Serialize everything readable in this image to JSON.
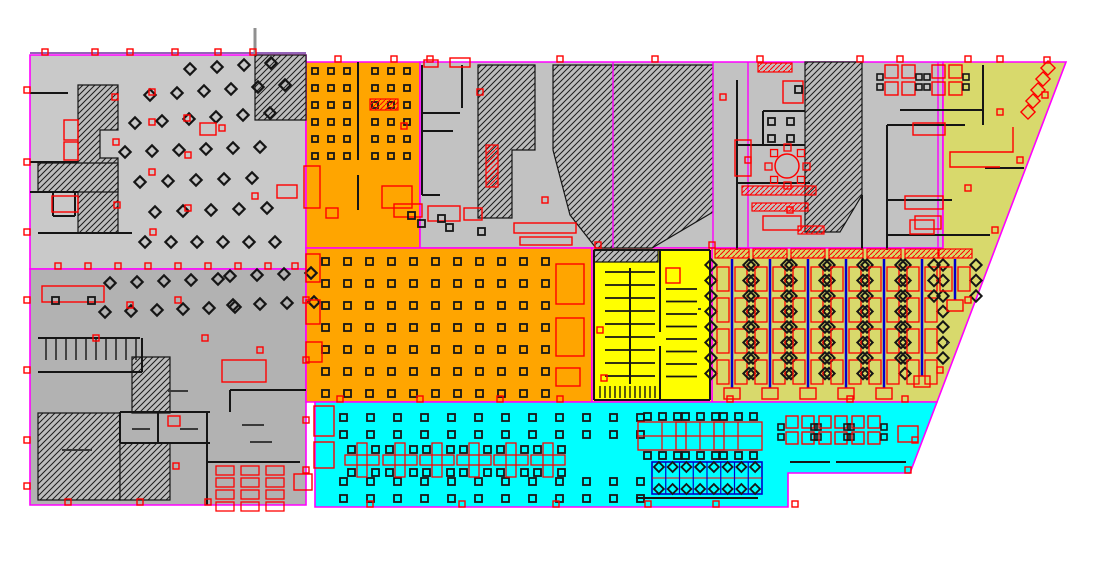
{
  "meta": {
    "width": 1111,
    "height": 562,
    "description": "CAD office floor plan with colored occupancy zones"
  },
  "colors": {
    "outline_magenta": "#FF00FF",
    "outline_violet": "#7030A0",
    "wall_black": "#151515",
    "furniture_red": "#FF0000",
    "accent_blue": "#0000CC",
    "zone_gray_light": "#C9C9C9",
    "zone_gray_mid": "#C2C2C2",
    "zone_gray_dark": "#B2B2B2",
    "zone_orange": "#FFA500",
    "zone_yellow": "#FFFF00",
    "zone_cyan": "#00FFFF",
    "zone_olive": "#D8D96C",
    "hatch_bg": "#BDBDBD",
    "pole_gray": "#909090",
    "chair_dark": "#161616",
    "label_gray": "#3a3a3a"
  },
  "zones": [
    {
      "name": "zone-left-upper-gray",
      "color": "zone_gray_light",
      "points": "30,55 306,55 306,269 30,269"
    },
    {
      "name": "zone-left-lower-gray",
      "color": "zone_gray_dark",
      "points": "30,269 306,269 306,505 30,505"
    },
    {
      "name": "zone-orange-upper",
      "color": "zone_orange",
      "points": "306,62 420,62 420,248 306,248"
    },
    {
      "name": "zone-center-gray-band",
      "color": "zone_gray_mid",
      "points": "420,62 943,62 943,248 420,248"
    },
    {
      "name": "zone-olive-right",
      "color": "zone_olive",
      "points": "943,62 1066,62 937,402 712,402 712,248 943,248"
    },
    {
      "name": "zone-orange-main",
      "color": "zone_orange",
      "points": "306,248 592,248 592,402 306,402"
    },
    {
      "name": "zone-yellow-core",
      "color": "zone_yellow",
      "points": "592,248 712,248 712,402 592,402"
    },
    {
      "name": "zone-cyan-open-office",
      "color": "zone_cyan",
      "points": "315,402 937,402 910,473 788,473 788,507 315,507"
    }
  ],
  "hatches": [
    {
      "name": "hatch-left-top-right",
      "points": "255,55 306,55 306,120 255,120"
    },
    {
      "name": "hatch-left-core",
      "points": "78,85 118,85 118,130 100,130 100,158 118,158 118,233 78,233"
    },
    {
      "name": "hatch-left-bar",
      "points": "38,163 118,163 118,192 38,192"
    },
    {
      "name": "hatch-lower-a",
      "points": "38,413 120,413 120,500 38,500"
    },
    {
      "name": "hatch-lower-b",
      "points": "120,443 170,443 170,500 120,500"
    },
    {
      "name": "hatch-lower-c",
      "points": "132,357 170,357 170,413 132,413"
    },
    {
      "name": "hatch-center-1",
      "points": "478,65 535,65 535,150 512,150 512,218 478,218"
    },
    {
      "name": "hatch-center-2",
      "points": "553,65 713,65 713,212 652,248 596,248 570,215 553,150"
    },
    {
      "name": "hatch-right-1",
      "points": "805,62 862,62 862,195 840,232 805,232"
    },
    {
      "name": "hatch-yellow-strip",
      "points": "594,250 658,250 658,262 594,262"
    }
  ],
  "magenta_lines": [
    [
      613,
      62,
      613,
      248
    ],
    [
      713,
      62,
      713,
      248
    ],
    [
      748,
      62,
      748,
      248
    ],
    [
      938,
      62,
      938,
      248
    ]
  ],
  "walls": [
    [
      30,
      93,
      68,
      93
    ],
    [
      30,
      162,
      78,
      162
    ],
    [
      30,
      192,
      78,
      192
    ],
    [
      53,
      192,
      53,
      216
    ],
    [
      75,
      192,
      75,
      216
    ],
    [
      53,
      216,
      75,
      216
    ],
    [
      38,
      233,
      132,
      233
    ],
    [
      38,
      338,
      140,
      338
    ],
    [
      38,
      372,
      142,
      372
    ],
    [
      142,
      338,
      142,
      372
    ],
    [
      120,
      412,
      210,
      412
    ],
    [
      120,
      443,
      210,
      443
    ],
    [
      120,
      412,
      120,
      443
    ],
    [
      158,
      412,
      158,
      443
    ],
    [
      207,
      412,
      207,
      443
    ],
    [
      207,
      443,
      207,
      505
    ],
    [
      207,
      462,
      300,
      462
    ],
    [
      230,
      390,
      306,
      390
    ],
    [
      230,
      390,
      230,
      412
    ],
    [
      422,
      65,
      422,
      195
    ],
    [
      422,
      113,
      460,
      113
    ],
    [
      422,
      131,
      453,
      131
    ],
    [
      462,
      65,
      462,
      108
    ],
    [
      422,
      195,
      440,
      195
    ],
    [
      737,
      80,
      737,
      250
    ],
    [
      737,
      145,
      805,
      145
    ],
    [
      763,
      111,
      805,
      111
    ],
    [
      763,
      111,
      763,
      145
    ],
    [
      737,
      183,
      810,
      183
    ],
    [
      862,
      195,
      862,
      250
    ],
    [
      887,
      125,
      887,
      250
    ],
    [
      887,
      125,
      965,
      125
    ],
    [
      983,
      65,
      983,
      125
    ],
    [
      900,
      110,
      983,
      110
    ],
    [
      985,
      168,
      1024,
      168
    ],
    [
      887,
      200,
      952,
      200
    ],
    [
      887,
      235,
      990,
      235
    ],
    [
      594,
      250,
      710,
      250
    ],
    [
      594,
      400,
      710,
      400
    ],
    [
      594,
      250,
      594,
      400
    ],
    [
      710,
      250,
      710,
      400
    ],
    [
      660,
      250,
      660,
      332
    ],
    [
      660,
      346,
      660,
      400
    ],
    [
      630,
      268,
      630,
      384
    ],
    [
      636,
      498,
      758,
      498
    ],
    [
      836,
      462,
      906,
      462
    ],
    [
      790,
      462,
      830,
      462
    ],
    [
      358,
      62,
      358,
      160
    ],
    [
      358,
      175,
      358,
      210
    ]
  ],
  "combs": [
    {
      "x0": 46,
      "y": 338,
      "n": 10,
      "dx": 10,
      "len": 22
    },
    {
      "x0": 600,
      "y": 386,
      "n": 12,
      "dx": 5,
      "len": 12
    }
  ],
  "stall_groups": [
    {
      "x1": 605,
      "x2": 629,
      "y0": 272,
      "n": 9,
      "dy": 13
    },
    {
      "x1": 631,
      "x2": 655,
      "y0": 272,
      "n": 9,
      "dy": 13
    },
    {
      "x1": 666,
      "x2": 697,
      "y0": 289,
      "n": 8,
      "dy": 12.5
    }
  ],
  "square_grids": [
    {
      "x0": 312,
      "y0": 68,
      "cols": 3,
      "rows": 6,
      "dx": 16,
      "dy": 17,
      "s": 6
    },
    {
      "x0": 372,
      "y0": 68,
      "cols": 3,
      "rows": 6,
      "dx": 16,
      "dy": 17,
      "s": 6
    },
    {
      "x0": 322,
      "y0": 258,
      "cols": 11,
      "rows": 7,
      "dx": 22,
      "dy": 22,
      "s": 7
    },
    {
      "x0": 340,
      "y0": 414,
      "cols": 12,
      "rows": 2,
      "dx": 27,
      "dy": 17,
      "s": 7
    },
    {
      "x0": 340,
      "y0": 478,
      "cols": 12,
      "rows": 2,
      "dx": 27,
      "dy": 17,
      "s": 7
    },
    {
      "x0": 768,
      "y0": 118,
      "cols": 2,
      "rows": 2,
      "dx": 19,
      "dy": 17,
      "s": 7
    }
  ],
  "diamond_rows": [
    {
      "x0": 190,
      "y0": 69,
      "n": 4,
      "dx": 27,
      "dy": -2
    },
    {
      "x0": 150,
      "y0": 95,
      "n": 6,
      "dx": 27,
      "dy": -2
    },
    {
      "x0": 135,
      "y0": 123,
      "n": 6,
      "dx": 27,
      "dy": -2
    },
    {
      "x0": 125,
      "y0": 152,
      "n": 6,
      "dx": 27,
      "dy": -1
    },
    {
      "x0": 140,
      "y0": 182,
      "n": 5,
      "dx": 28,
      "dy": -1
    },
    {
      "x0": 155,
      "y0": 212,
      "n": 5,
      "dx": 28,
      "dy": -1
    },
    {
      "x0": 145,
      "y0": 242,
      "n": 6,
      "dx": 26,
      "dy": 0
    },
    {
      "x0": 110,
      "y0": 283,
      "n": 5,
      "dx": 27,
      "dy": -1
    },
    {
      "x0": 230,
      "y0": 276,
      "n": 4,
      "dx": 27,
      "dy": -1
    },
    {
      "x0": 105,
      "y0": 312,
      "n": 6,
      "dx": 26,
      "dy": -1
    },
    {
      "x0": 233,
      "y0": 305,
      "n": 4,
      "dx": 27,
      "dy": -1
    }
  ],
  "bench_columns": [
    {
      "cx": 732,
      "y0": 249,
      "y1": 400
    },
    {
      "cx": 770,
      "y0": 249,
      "y1": 400
    },
    {
      "cx": 808,
      "y0": 249,
      "y1": 400
    },
    {
      "cx": 846,
      "y0": 249,
      "y1": 400
    },
    {
      "cx": 884,
      "y0": 249,
      "y1": 400
    },
    {
      "cx": 922,
      "y0": 249,
      "y1": 388
    },
    {
      "cx": 955,
      "y0": 249,
      "y1": 312
    }
  ],
  "plus_clusters": [
    {
      "cx": 362,
      "cy": 460
    },
    {
      "cx": 400,
      "cy": 460
    },
    {
      "cx": 437,
      "cy": 460
    },
    {
      "cx": 474,
      "cy": 460
    },
    {
      "cx": 511,
      "cy": 460
    },
    {
      "cx": 548,
      "cy": 460
    }
  ],
  "h_benches": [
    {
      "cx": 662,
      "cy": 436
    },
    {
      "cx": 700,
      "cy": 436
    },
    {
      "cx": 738,
      "cy": 436
    }
  ],
  "quad_clusters": [
    {
      "cx": 800,
      "cy": 430,
      "s": 12
    },
    {
      "cx": 833,
      "cy": 430,
      "s": 12
    },
    {
      "cx": 866,
      "cy": 430,
      "s": 12
    },
    {
      "cx": 900,
      "cy": 80,
      "s": 13
    },
    {
      "cx": 947,
      "cy": 80,
      "s": 13
    }
  ],
  "blue_bench": {
    "x": 652,
    "y": 462,
    "w": 110,
    "h": 32,
    "cells": 8
  },
  "round_table": {
    "cx": 787,
    "cy": 166,
    "r": 12
  },
  "stairs": {
    "x0": 1048,
    "y0": 68,
    "n": 5,
    "dx": -5,
    "dy": 11,
    "s": 10
  },
  "red_polylines": [
    "1013,127 1013,152 950,152 950,167 1000,167"
  ],
  "red_rects": [
    [
      64,
      120,
      14,
      20
    ],
    [
      64,
      142,
      14,
      18
    ],
    [
      52,
      196,
      26,
      16
    ],
    [
      277,
      185,
      20,
      13
    ],
    [
      200,
      123,
      16,
      12
    ],
    [
      42,
      286,
      62,
      16
    ],
    [
      222,
      360,
      44,
      22
    ],
    [
      294,
      474,
      18,
      16
    ],
    [
      168,
      416,
      12,
      10
    ],
    [
      304,
      166,
      16,
      42
    ],
    [
      382,
      186,
      30,
      22
    ],
    [
      326,
      208,
      12,
      10
    ],
    [
      556,
      264,
      28,
      40
    ],
    [
      556,
      318,
      28,
      38
    ],
    [
      556,
      368,
      24,
      18
    ],
    [
      306,
      254,
      14,
      28
    ],
    [
      306,
      300,
      14,
      24
    ],
    [
      306,
      342,
      16,
      20
    ],
    [
      394,
      204,
      28,
      13
    ],
    [
      428,
      206,
      32,
      15
    ],
    [
      464,
      208,
      18,
      12
    ],
    [
      514,
      223,
      62,
      10
    ],
    [
      520,
      237,
      52,
      8
    ],
    [
      450,
      58,
      20,
      9
    ],
    [
      424,
      60,
      14,
      7
    ],
    [
      783,
      81,
      20,
      22
    ],
    [
      735,
      140,
      16,
      36
    ],
    [
      763,
      216,
      38,
      14
    ],
    [
      905,
      196,
      38,
      13
    ],
    [
      913,
      123,
      32,
      12
    ],
    [
      915,
      216,
      26,
      13
    ],
    [
      910,
      220,
      24,
      14
    ],
    [
      314,
      406,
      20,
      30
    ],
    [
      314,
      442,
      20,
      26
    ],
    [
      898,
      426,
      20,
      16
    ],
    [
      666,
      268,
      14,
      15
    ]
  ],
  "red_hatch_rects": [
    [
      370,
      99,
      28,
      11
    ],
    [
      758,
      63,
      34,
      9
    ],
    [
      742,
      186,
      74,
      9
    ],
    [
      752,
      203,
      56,
      8
    ],
    [
      486,
      145,
      12,
      42
    ],
    [
      798,
      226,
      26,
      8
    ]
  ],
  "red_desk_grid": {
    "x0": 216,
    "y0": 466,
    "cols": 3,
    "rows": 4,
    "dx": 25,
    "dy": 12,
    "w": 18,
    "h": 9
  },
  "markers_red": [
    [
      45,
      52
    ],
    [
      95,
      52
    ],
    [
      130,
      52
    ],
    [
      175,
      52
    ],
    [
      218,
      52
    ],
    [
      253,
      52
    ],
    [
      27,
      90
    ],
    [
      27,
      162
    ],
    [
      27,
      232
    ],
    [
      27,
      300
    ],
    [
      27,
      370
    ],
    [
      27,
      440
    ],
    [
      27,
      486
    ],
    [
      58,
      266
    ],
    [
      88,
      266
    ],
    [
      118,
      266
    ],
    [
      148,
      266
    ],
    [
      178,
      266
    ],
    [
      208,
      266
    ],
    [
      238,
      266
    ],
    [
      268,
      266
    ],
    [
      295,
      266
    ],
    [
      338,
      59
    ],
    [
      394,
      59
    ],
    [
      430,
      59
    ],
    [
      560,
      59
    ],
    [
      655,
      59
    ],
    [
      760,
      59
    ],
    [
      860,
      59
    ],
    [
      900,
      59
    ],
    [
      968,
      59
    ],
    [
      1000,
      59
    ],
    [
      1047,
      60
    ],
    [
      1045,
      95
    ],
    [
      1020,
      160
    ],
    [
      995,
      230
    ],
    [
      968,
      300
    ],
    [
      940,
      370
    ],
    [
      915,
      440
    ],
    [
      370,
      504
    ],
    [
      462,
      504
    ],
    [
      556,
      504
    ],
    [
      648,
      504
    ],
    [
      716,
      504
    ],
    [
      795,
      504
    ],
    [
      68,
      502
    ],
    [
      140,
      502
    ],
    [
      208,
      502
    ],
    [
      306,
      300
    ],
    [
      306,
      360
    ],
    [
      306,
      420
    ],
    [
      306,
      470
    ],
    [
      340,
      399
    ],
    [
      420,
      399
    ],
    [
      500,
      399
    ],
    [
      560,
      399
    ],
    [
      730,
      399
    ],
    [
      850,
      399
    ],
    [
      905,
      399
    ],
    [
      598,
      245
    ],
    [
      712,
      245
    ],
    [
      115,
      97
    ],
    [
      152,
      92
    ],
    [
      187,
      118
    ],
    [
      152,
      122
    ],
    [
      116,
      142
    ],
    [
      188,
      155
    ],
    [
      152,
      172
    ],
    [
      117,
      205
    ],
    [
      188,
      208
    ],
    [
      153,
      232
    ],
    [
      222,
      128
    ],
    [
      255,
      196
    ],
    [
      130,
      305
    ],
    [
      178,
      300
    ],
    [
      205,
      338
    ],
    [
      96,
      338
    ],
    [
      260,
      350
    ],
    [
      600,
      330
    ],
    [
      604,
      378
    ],
    [
      404,
      126
    ],
    [
      480,
      92
    ],
    [
      545,
      200
    ],
    [
      723,
      97
    ],
    [
      748,
      160
    ],
    [
      790,
      210
    ],
    [
      1000,
      112
    ],
    [
      968,
      188
    ],
    [
      176,
      466
    ],
    [
      908,
      470
    ]
  ],
  "squares_black": [
    [
      52,
      297
    ],
    [
      88,
      297
    ],
    [
      795,
      86
    ],
    [
      418,
      220
    ],
    [
      446,
      224
    ],
    [
      478,
      228
    ],
    [
      408,
      212
    ],
    [
      438,
      215
    ]
  ],
  "micro_labels": [
    [
      62,
      449,
      30
    ],
    [
      132,
      428,
      18
    ],
    [
      180,
      428,
      18
    ],
    [
      168,
      390,
      20
    ],
    [
      242,
      424,
      22
    ],
    [
      250,
      441,
      22
    ],
    [
      698,
      308,
      3
    ],
    [
      946,
      342,
      3
    ]
  ],
  "pole": {
    "x": 255,
    "y1": 28,
    "y2": 56
  }
}
